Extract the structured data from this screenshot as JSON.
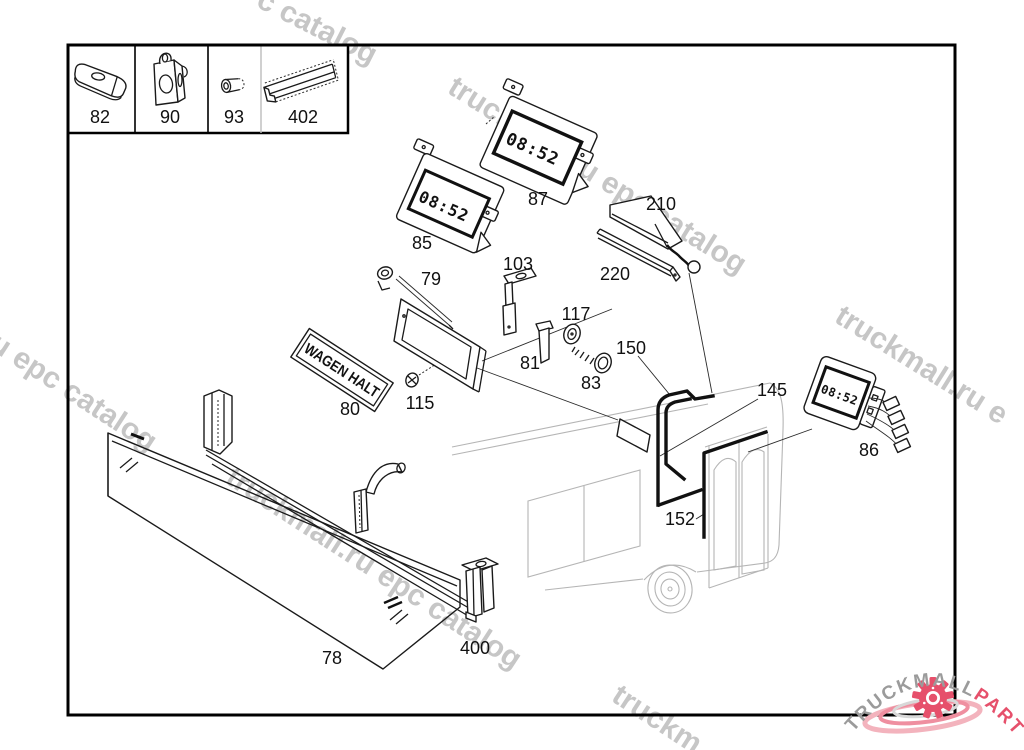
{
  "diagram": {
    "display_time": "08:52",
    "sign_text": "WAGEN HALT",
    "part_labels": {
      "78": "78",
      "79": "79",
      "80": "80",
      "81": "81",
      "82": "82",
      "83": "83",
      "85": "85",
      "86": "86",
      "87": "87",
      "90": "90",
      "93": "93",
      "103": "103",
      "115": "115",
      "117": "117",
      "145": "145",
      "150": "150",
      "152": "152",
      "210": "210",
      "220": "220",
      "400": "400",
      "402": "402"
    }
  },
  "legend": {
    "cells": [
      "82",
      "90",
      "93",
      "402"
    ]
  },
  "watermarks": {
    "top": "c catalog",
    "upper": "truckmall.ru epc catalog",
    "left": "u epc catalog",
    "middle": "truckmall.ru epc catalog",
    "right": "truckmall.ru e",
    "bottom": "truckm"
  },
  "logo": {
    "brand": "TRUCKMALL",
    "suffix": "PARTS"
  },
  "colors": {
    "watermark": "#c6c6c6",
    "bus_outline": "#b5b5b5",
    "line": "#1a1a1a",
    "seal": "#111111",
    "logo_gray": "#9b9b9b",
    "logo_pink": "#e6506b",
    "logo_swoosh_light": "#f3b3bd",
    "logo_swoosh_mid": "#ef8fa0",
    "logo_swoosh_gray": "#d8d8d8"
  }
}
